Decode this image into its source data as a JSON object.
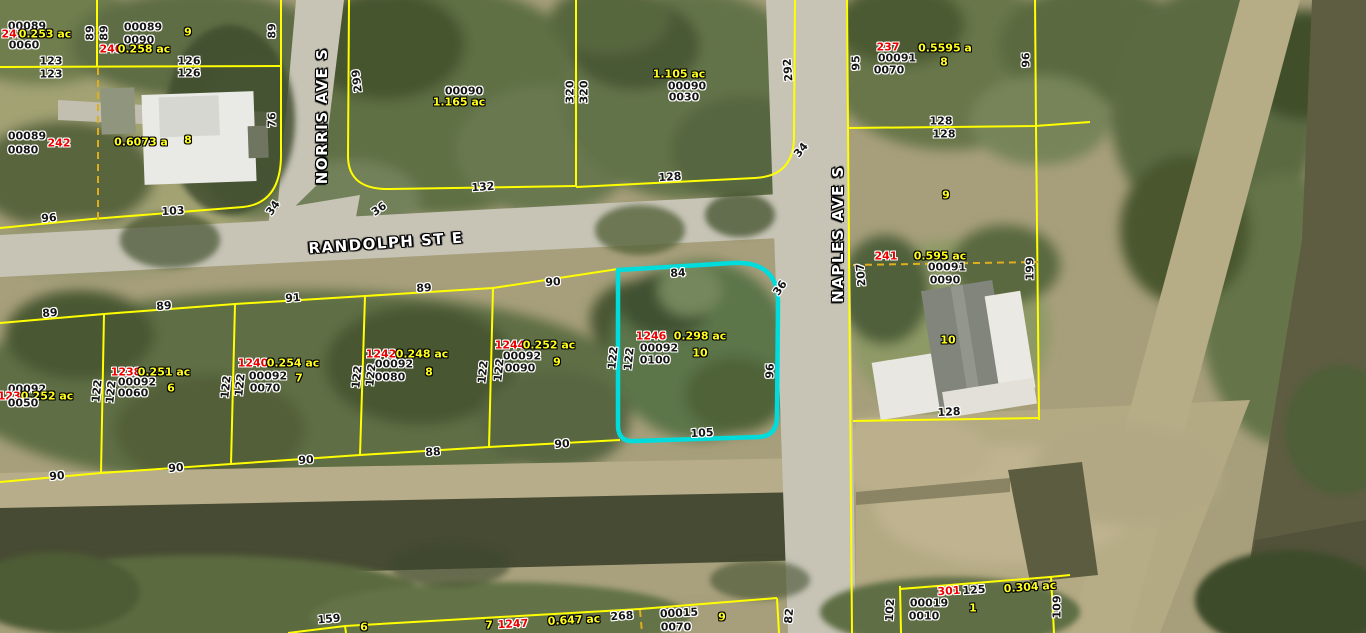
{
  "map": {
    "streets": {
      "randolph": "RANDOLPH ST E",
      "norris": "NORRIS AVE S",
      "naples": "NAPLES AVE S"
    },
    "colors": {
      "parcel_line": "#ffff00",
      "internal_lot_line": "#dfae1c",
      "highlight_outline": "#00dcdc",
      "parcel_number_red": "#ee0000",
      "area_lot_yellow": "#ffff1e",
      "id_dimension_black": "#151515",
      "street_name_white": "#ffffff"
    },
    "highlighted_parcel": {
      "parcel_number": "1246",
      "area": "0.298 ac",
      "strap_line1": "00092",
      "strap_line2": "0100",
      "lot": "10",
      "dim_top": "84",
      "dim_right": "96",
      "dim_bottom": "105",
      "dim_left": "122",
      "dim_corner": "36"
    },
    "labels": [
      {
        "t": "RANDOLPH ST E",
        "c": "s",
        "x": 386,
        "y": 243,
        "r": -4,
        "n": "street-label-randolph"
      },
      {
        "t": "NORRIS AVE S",
        "c": "s",
        "x": 322,
        "y": 116,
        "r": -90,
        "n": "street-label-norris"
      },
      {
        "t": "NAPLES AVE S",
        "c": "s",
        "x": 838,
        "y": 234,
        "r": -90,
        "n": "street-label-naples"
      },
      {
        "t": "00089",
        "c": "k",
        "x": 27,
        "y": 26
      },
      {
        "t": "241",
        "c": "r",
        "x": 13,
        "y": 34
      },
      {
        "t": "0.253 ac",
        "c": "y",
        "x": 45,
        "y": 34
      },
      {
        "t": "0060",
        "c": "k",
        "x": 24,
        "y": 45
      },
      {
        "t": "00089",
        "c": "k",
        "x": 143,
        "y": 27
      },
      {
        "t": "0090",
        "c": "k",
        "x": 139,
        "y": 40
      },
      {
        "t": "9",
        "c": "y",
        "x": 188,
        "y": 32
      },
      {
        "t": "240",
        "c": "r",
        "x": 111,
        "y": 49
      },
      {
        "t": "0.258 ac",
        "c": "y",
        "x": 144,
        "y": 49
      },
      {
        "t": "89",
        "c": "k",
        "x": 90,
        "y": 33,
        "r": -90
      },
      {
        "t": "89",
        "c": "k",
        "x": 104,
        "y": 33,
        "r": -90
      },
      {
        "t": "89",
        "c": "k",
        "x": 272,
        "y": 31,
        "r": -90
      },
      {
        "t": "123",
        "c": "k",
        "x": 51,
        "y": 61
      },
      {
        "t": "123",
        "c": "k",
        "x": 51,
        "y": 74
      },
      {
        "t": "126",
        "c": "k",
        "x": 189,
        "y": 61
      },
      {
        "t": "126",
        "c": "k",
        "x": 189,
        "y": 73
      },
      {
        "t": "00089",
        "c": "k",
        "x": 27,
        "y": 136
      },
      {
        "t": "242",
        "c": "r",
        "x": 59,
        "y": 143
      },
      {
        "t": "0080",
        "c": "k",
        "x": 23,
        "y": 150
      },
      {
        "t": "0.6073 a",
        "c": "y",
        "x": 141,
        "y": 142
      },
      {
        "t": "8",
        "c": "y",
        "x": 188,
        "y": 140
      },
      {
        "t": "76",
        "c": "k",
        "x": 272,
        "y": 120,
        "r": -90
      },
      {
        "t": "103",
        "c": "k",
        "x": 173,
        "y": 211,
        "r": -3
      },
      {
        "t": "34",
        "c": "k",
        "x": 273,
        "y": 208,
        "r": -55
      },
      {
        "t": "96",
        "c": "k",
        "x": 49,
        "y": 218,
        "r": -5
      },
      {
        "t": "299",
        "c": "k",
        "x": 357,
        "y": 81,
        "r": -97
      },
      {
        "t": "00090",
        "c": "k",
        "x": 464,
        "y": 91
      },
      {
        "t": "1.165 ac",
        "c": "y",
        "x": 459,
        "y": 102
      },
      {
        "t": "320",
        "c": "k",
        "x": 570,
        "y": 92,
        "r": -90
      },
      {
        "t": "320",
        "c": "k",
        "x": 584,
        "y": 92,
        "r": -90
      },
      {
        "t": "132",
        "c": "k",
        "x": 483,
        "y": 187,
        "r": -4
      },
      {
        "t": "36",
        "c": "k",
        "x": 379,
        "y": 209,
        "r": -35
      },
      {
        "t": "1.105 ac",
        "c": "y",
        "x": 679,
        "y": 74
      },
      {
        "t": "00090",
        "c": "k",
        "x": 687,
        "y": 86
      },
      {
        "t": "0030",
        "c": "k",
        "x": 684,
        "y": 97
      },
      {
        "t": "292",
        "c": "k",
        "x": 788,
        "y": 70,
        "r": -95
      },
      {
        "t": "128",
        "c": "k",
        "x": 670,
        "y": 177,
        "r": -4
      },
      {
        "t": "34",
        "c": "k",
        "x": 801,
        "y": 150,
        "r": -50
      },
      {
        "t": "95",
        "c": "k",
        "x": 856,
        "y": 63,
        "r": -90
      },
      {
        "t": "237",
        "c": "r",
        "x": 888,
        "y": 47
      },
      {
        "t": "00091",
        "c": "k",
        "x": 897,
        "y": 58
      },
      {
        "t": "0070",
        "c": "k",
        "x": 889,
        "y": 70
      },
      {
        "t": "0.5595 a",
        "c": "y",
        "x": 945,
        "y": 48
      },
      {
        "t": "8",
        "c": "y",
        "x": 944,
        "y": 62
      },
      {
        "t": "96",
        "c": "k",
        "x": 1026,
        "y": 60,
        "r": -90
      },
      {
        "t": "128",
        "c": "k",
        "x": 941,
        "y": 121
      },
      {
        "t": "128",
        "c": "k",
        "x": 944,
        "y": 134
      },
      {
        "t": "9",
        "c": "y",
        "x": 946,
        "y": 195
      },
      {
        "t": "241",
        "c": "r",
        "x": 886,
        "y": 256
      },
      {
        "t": "0.595 ac",
        "c": "y",
        "x": 940,
        "y": 256
      },
      {
        "t": "00091",
        "c": "k",
        "x": 947,
        "y": 267
      },
      {
        "t": "0090",
        "c": "k",
        "x": 945,
        "y": 280
      },
      {
        "t": "207",
        "c": "k",
        "x": 861,
        "y": 275,
        "r": -95
      },
      {
        "t": "199",
        "c": "k",
        "x": 1030,
        "y": 269,
        "r": -90
      },
      {
        "t": "10",
        "c": "y",
        "x": 948,
        "y": 340
      },
      {
        "t": "128",
        "c": "k",
        "x": 949,
        "y": 412,
        "r": -3
      },
      {
        "t": "84",
        "c": "k",
        "x": 678,
        "y": 273,
        "r": -3,
        "n": "highlight-dim-top"
      },
      {
        "t": "36",
        "c": "k",
        "x": 780,
        "y": 288,
        "r": -55,
        "n": "highlight-dim-corner"
      },
      {
        "t": "1246",
        "c": "r",
        "x": 651,
        "y": 336,
        "n": "highlight-parcel-number"
      },
      {
        "t": "0.298 ac",
        "c": "y",
        "x": 700,
        "y": 336,
        "n": "highlight-area"
      },
      {
        "t": "00092",
        "c": "k",
        "x": 659,
        "y": 348,
        "n": "highlight-strap-1"
      },
      {
        "t": "10",
        "c": "y",
        "x": 700,
        "y": 353,
        "n": "highlight-lot"
      },
      {
        "t": "0100",
        "c": "k",
        "x": 655,
        "y": 360,
        "n": "highlight-strap-2"
      },
      {
        "t": "122",
        "c": "k",
        "x": 613,
        "y": 358,
        "r": -84
      },
      {
        "t": "122",
        "c": "k",
        "x": 629,
        "y": 359,
        "r": -84
      },
      {
        "t": "96",
        "c": "k",
        "x": 770,
        "y": 371,
        "r": -88,
        "n": "highlight-dim-right"
      },
      {
        "t": "105",
        "c": "k",
        "x": 702,
        "y": 433,
        "r": -3,
        "n": "highlight-dim-bottom"
      },
      {
        "t": "00092",
        "c": "k",
        "x": 27,
        "y": 389
      },
      {
        "t": "1236",
        "c": "r",
        "x": 13,
        "y": 396
      },
      {
        "t": "0.252 ac",
        "c": "y",
        "x": 47,
        "y": 396
      },
      {
        "t": "0050",
        "c": "k",
        "x": 23,
        "y": 403
      },
      {
        "t": "122",
        "c": "k",
        "x": 97,
        "y": 391,
        "r": -84
      },
      {
        "t": "122",
        "c": "k",
        "x": 111,
        "y": 392,
        "r": -84
      },
      {
        "t": "1238",
        "c": "r",
        "x": 126,
        "y": 372
      },
      {
        "t": "0.251 ac",
        "c": "y",
        "x": 164,
        "y": 372
      },
      {
        "t": "00092",
        "c": "k",
        "x": 137,
        "y": 382
      },
      {
        "t": "6",
        "c": "y",
        "x": 171,
        "y": 388
      },
      {
        "t": "0060",
        "c": "k",
        "x": 133,
        "y": 393
      },
      {
        "t": "122",
        "c": "k",
        "x": 226,
        "y": 387,
        "r": -84
      },
      {
        "t": "122",
        "c": "k",
        "x": 240,
        "y": 385,
        "r": -84
      },
      {
        "t": "1240",
        "c": "r",
        "x": 253,
        "y": 363
      },
      {
        "t": "0.254 ac",
        "c": "y",
        "x": 293,
        "y": 363
      },
      {
        "t": "00092",
        "c": "k",
        "x": 268,
        "y": 376
      },
      {
        "t": "7",
        "c": "y",
        "x": 299,
        "y": 378
      },
      {
        "t": "0070",
        "c": "k",
        "x": 265,
        "y": 388
      },
      {
        "t": "122",
        "c": "k",
        "x": 357,
        "y": 377,
        "r": -84
      },
      {
        "t": "122",
        "c": "k",
        "x": 371,
        "y": 375,
        "r": -84
      },
      {
        "t": "1242",
        "c": "r",
        "x": 381,
        "y": 354
      },
      {
        "t": "0.248 ac",
        "c": "y",
        "x": 422,
        "y": 354
      },
      {
        "t": "00092",
        "c": "k",
        "x": 394,
        "y": 364
      },
      {
        "t": "8",
        "c": "y",
        "x": 429,
        "y": 372
      },
      {
        "t": "0080",
        "c": "k",
        "x": 390,
        "y": 377
      },
      {
        "t": "122",
        "c": "k",
        "x": 483,
        "y": 372,
        "r": -84
      },
      {
        "t": "122",
        "c": "k",
        "x": 499,
        "y": 370,
        "r": -84
      },
      {
        "t": "1244",
        "c": "r",
        "x": 510,
        "y": 345
      },
      {
        "t": "0.252 ac",
        "c": "y",
        "x": 549,
        "y": 345
      },
      {
        "t": "00092",
        "c": "k",
        "x": 522,
        "y": 356
      },
      {
        "t": "9",
        "c": "y",
        "x": 557,
        "y": 362
      },
      {
        "t": "0090",
        "c": "k",
        "x": 520,
        "y": 368
      },
      {
        "t": "89",
        "c": "k",
        "x": 50,
        "y": 313,
        "r": -5
      },
      {
        "t": "89",
        "c": "k",
        "x": 164,
        "y": 306,
        "r": -5
      },
      {
        "t": "91",
        "c": "k",
        "x": 293,
        "y": 298,
        "r": -5
      },
      {
        "t": "89",
        "c": "k",
        "x": 424,
        "y": 288,
        "r": -4
      },
      {
        "t": "90",
        "c": "k",
        "x": 553,
        "y": 282,
        "r": -4
      },
      {
        "t": "90",
        "c": "k",
        "x": 57,
        "y": 476,
        "r": -5
      },
      {
        "t": "90",
        "c": "k",
        "x": 176,
        "y": 468,
        "r": -5
      },
      {
        "t": "90",
        "c": "k",
        "x": 306,
        "y": 460,
        "r": -4
      },
      {
        "t": "88",
        "c": "k",
        "x": 433,
        "y": 452,
        "r": -4
      },
      {
        "t": "90",
        "c": "k",
        "x": 562,
        "y": 444,
        "r": -4
      },
      {
        "t": "159",
        "c": "k",
        "x": 329,
        "y": 619,
        "r": -5
      },
      {
        "t": "6",
        "c": "y",
        "x": 364,
        "y": 627
      },
      {
        "t": "7",
        "c": "y",
        "x": 489,
        "y": 625
      },
      {
        "t": "1247",
        "c": "r",
        "x": 513,
        "y": 624,
        "r": -3
      },
      {
        "t": "0.647 ac",
        "c": "y",
        "x": 574,
        "y": 620,
        "r": -3
      },
      {
        "t": "268",
        "c": "k",
        "x": 622,
        "y": 616,
        "r": -4
      },
      {
        "t": "00015",
        "c": "k",
        "x": 679,
        "y": 613,
        "r": -3
      },
      {
        "t": "0070",
        "c": "k",
        "x": 676,
        "y": 627
      },
      {
        "t": "9",
        "c": "y",
        "x": 722,
        "y": 617
      },
      {
        "t": "82",
        "c": "k",
        "x": 789,
        "y": 616,
        "r": -85
      },
      {
        "t": "301",
        "c": "r",
        "x": 949,
        "y": 591,
        "r": -4
      },
      {
        "t": "125",
        "c": "k",
        "x": 974,
        "y": 590,
        "r": -4
      },
      {
        "t": "0.304 ac",
        "c": "y",
        "x": 1030,
        "y": 587,
        "r": -4
      },
      {
        "t": "00019",
        "c": "k",
        "x": 929,
        "y": 603
      },
      {
        "t": "0010",
        "c": "k",
        "x": 924,
        "y": 616
      },
      {
        "t": "1",
        "c": "y",
        "x": 973,
        "y": 608
      },
      {
        "t": "102",
        "c": "k",
        "x": 890,
        "y": 610,
        "r": -87
      },
      {
        "t": "109",
        "c": "k",
        "x": 1057,
        "y": 607,
        "r": -90
      }
    ]
  }
}
